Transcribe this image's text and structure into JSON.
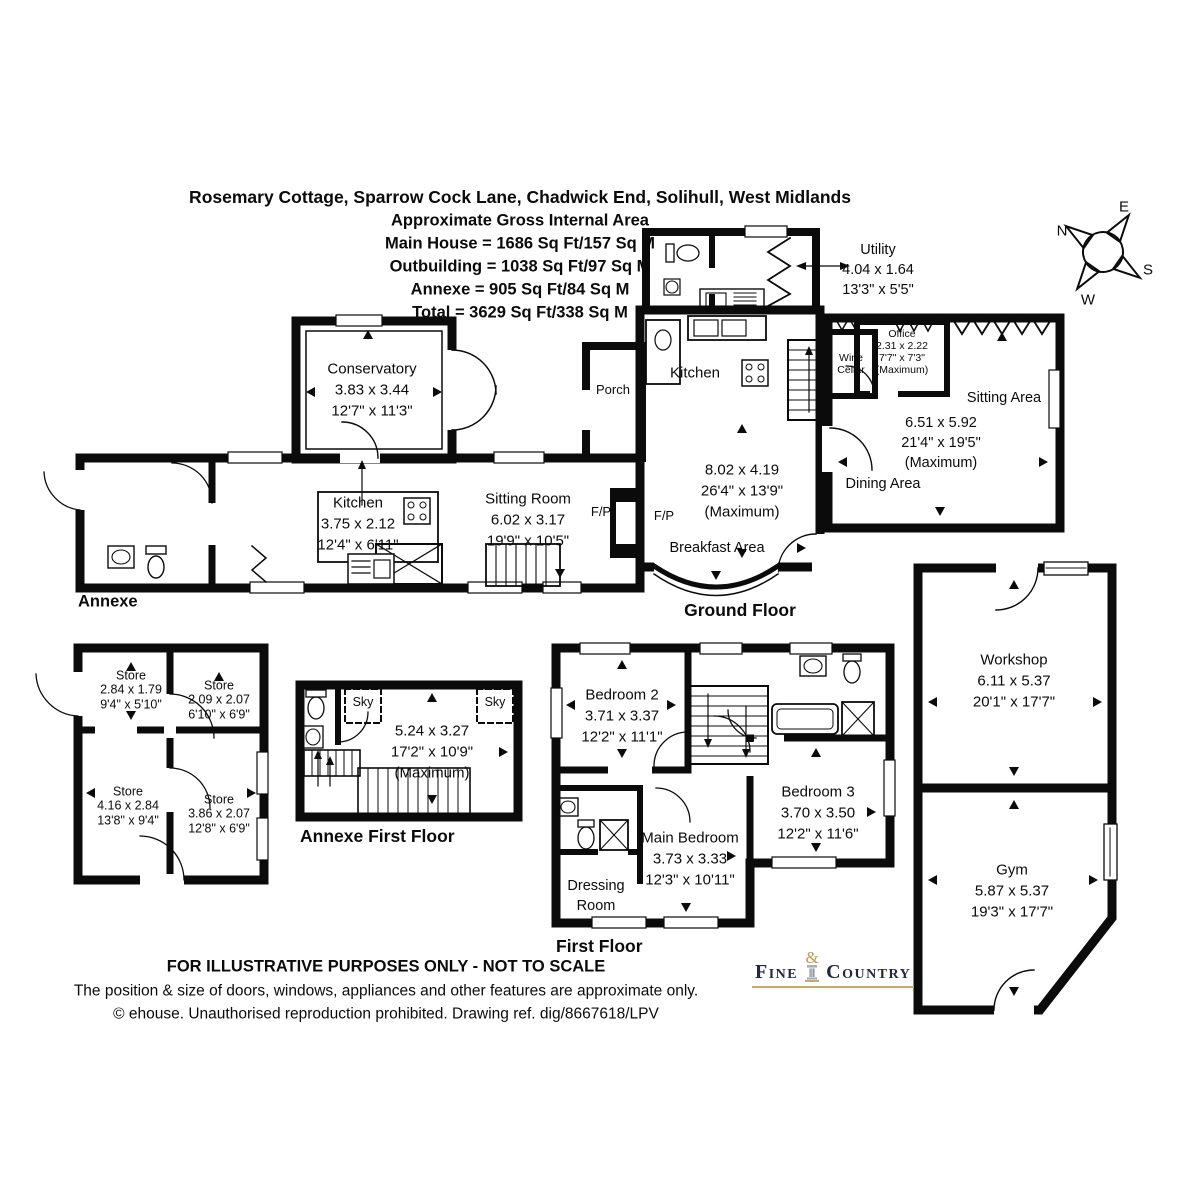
{
  "header": {
    "address": "Rosemary Cottage, Sparrow Cock Lane, Chadwick End, Solihull, West Midlands",
    "subtitle": "Approximate Gross Internal Area",
    "main_house": "Main House = 1686 Sq Ft/157 Sq M",
    "outbuilding": "Outbuilding = 1038 Sq Ft/97 Sq M",
    "annexe": "Annexe = 905 Sq Ft/84 Sq M",
    "total": "Total = 3629 Sq Ft/338 Sq M"
  },
  "compass": {
    "n": "N",
    "e": "E",
    "s": "S",
    "w": "W"
  },
  "ground_floor": {
    "floor_label": "Ground Floor",
    "annexe_label": "Annexe",
    "conservatory": {
      "name": "Conservatory",
      "metric": "3.83 x 3.44",
      "imperial": "12'7\" x 11'3\""
    },
    "annexe_kitchen": {
      "name": "Kitchen",
      "metric": "3.75 x 2.12",
      "imperial": "12'4\" x 6'11\""
    },
    "sitting_room": {
      "name": "Sitting Room",
      "metric": "6.02 x 3.17",
      "imperial": "19'9\" x 10'5\""
    },
    "porch": {
      "name": "Porch"
    },
    "kitchen": {
      "name": "Kitchen"
    },
    "kitchen_breakfast_dims": {
      "metric": "8.02 x 4.19",
      "imperial": "26'4\" x 13'9\"",
      "note": "(Maximum)"
    },
    "breakfast_area": {
      "name": "Breakfast Area"
    },
    "fireplace_left": "F/P",
    "fireplace_right": "F/P",
    "utility": {
      "name": "Utility",
      "metric": "4.04 x 1.64",
      "imperial": "13'3\" x 5'5\""
    },
    "office": {
      "name": "Office",
      "metric": "2.31 x 2.22",
      "imperial": "7'7\" x 7'3\"",
      "note": "(Maximum)"
    },
    "wine_cellar": {
      "line1": "Wine",
      "line2": "Cellar"
    },
    "sitting_area": {
      "name": "Sitting Area"
    },
    "dining_area": {
      "name": "Dining Area"
    },
    "sitting_dining_dims": {
      "metric": "6.51 x 5.92",
      "imperial": "21'4\" x 19'5\"",
      "note": "(Maximum)"
    }
  },
  "annexe_stores": {
    "stores": [
      {
        "name": "Store",
        "metric": "2.84 x 1.79",
        "imperial": "9'4\" x 5'10\""
      },
      {
        "name": "Store",
        "metric": "2.09 x 2.07",
        "imperial": "6'10\" x 6'9\""
      },
      {
        "name": "Store",
        "metric": "4.16 x 2.84",
        "imperial": "13'8\" x 9'4\""
      },
      {
        "name": "Store",
        "metric": "3.86 x 2.07",
        "imperial": "12'8\" x 6'9\""
      }
    ]
  },
  "annexe_first_floor": {
    "floor_label": "Annexe First Floor",
    "room_dims": {
      "metric": "5.24 x 3.27",
      "imperial": "17'2\" x 10'9\"",
      "note": "(Maximum)"
    },
    "skylight_left": "Sky",
    "skylight_right": "Sky"
  },
  "first_floor": {
    "floor_label": "First Floor",
    "bedroom2": {
      "name": "Bedroom 2",
      "metric": "3.71 x 3.37",
      "imperial": "12'2\" x 11'1\""
    },
    "bedroom3": {
      "name": "Bedroom 3",
      "metric": "3.70 x 3.50",
      "imperial": "12'2\" x 11'6\""
    },
    "main_bedroom": {
      "name": "Main Bedroom",
      "metric": "3.73 x 3.33",
      "imperial": "12'3\" x 10'11\""
    },
    "dressing_room": {
      "line1": "Dressing",
      "line2": "Room"
    }
  },
  "outbuilding": {
    "workshop": {
      "name": "Workshop",
      "metric": "6.11 x 5.37",
      "imperial": "20'1\" x 17'7\""
    },
    "gym": {
      "name": "Gym",
      "metric": "5.87 x 5.37",
      "imperial": "19'3\" x 17'7\""
    }
  },
  "footer": {
    "disclaimer1": "FOR ILLUSTRATIVE PURPOSES ONLY - NOT TO SCALE",
    "disclaimer2": "The position & size of doors, windows, appliances and other features are approximate only.",
    "copyright": "© ehouse. Unauthorised reproduction prohibited. Drawing ref. dig/8667618/LPV"
  },
  "logo": {
    "fine": "Fine",
    "amp": "&",
    "country": "Country"
  },
  "colors": {
    "wall": "#0b0b0b",
    "logo_text": "#262641",
    "logo_gold": "#bf9b4f"
  }
}
